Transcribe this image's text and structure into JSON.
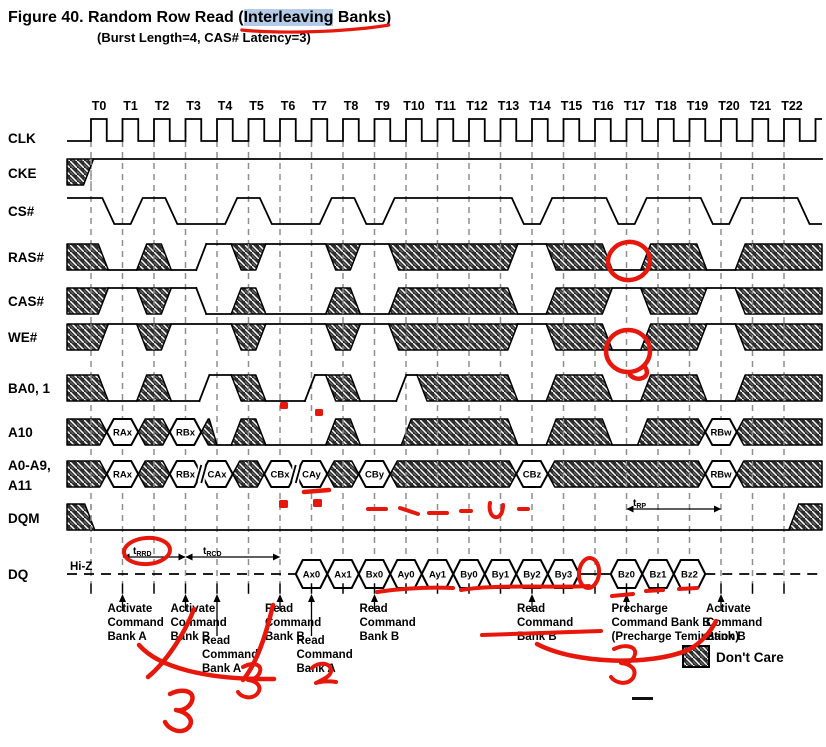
{
  "title": {
    "prefix": "Figure 40. Random Row Read (",
    "highlight": "Interleaving",
    "suffix": " Banks)",
    "subtitle": "(Burst Length=4, CAS# Latency=3)"
  },
  "colors": {
    "red": "#e8170b",
    "highlight_blue": "#b3cbe6",
    "hatch_bg": "#2d2d2d",
    "hatch_stripe": "#ffffff",
    "grid": "#8f8f8f",
    "black": "#000000"
  },
  "layout": {
    "t0_x": 91,
    "cycle_px": 31.5,
    "wave_left": 67,
    "wave_right": 822,
    "grid_top": 141,
    "grid_bot": 583,
    "tick_top": 584,
    "tick_bot": 593,
    "tlabel_y": 110,
    "clock_high": 119,
    "clock_low": 141
  },
  "time_labels": [
    "T0",
    "T1",
    "T2",
    "T3",
    "T4",
    "T5",
    "T6",
    "T7",
    "T8",
    "T9",
    "T10",
    "T11",
    "T12",
    "T13",
    "T14",
    "T15",
    "T16",
    "T17",
    "T18",
    "T19",
    "T20",
    "T21",
    "T22"
  ],
  "signals": [
    {
      "id": "clk",
      "label": "CLK",
      "type": "clock",
      "band": [
        119,
        141
      ],
      "label_y": 143
    },
    {
      "id": "cke",
      "label": "CKE",
      "type": "band",
      "band": [
        159,
        185
      ],
      "label_y": 178,
      "wins": [
        [
          0.08,
          99,
          "H"
        ]
      ]
    },
    {
      "id": "cs",
      "label": "CS#",
      "type": "cs",
      "band": [
        198,
        224
      ],
      "label_y": 216,
      "lows": [
        [
          0.55,
          1.45
        ],
        [
          2.55,
          4.45
        ],
        [
          5.55,
          7.45
        ],
        [
          8.55,
          9.45
        ],
        [
          13.55,
          14.45
        ],
        [
          16.55,
          17.45
        ],
        [
          19.55,
          20.45
        ],
        [
          22.62,
          99
        ]
      ]
    },
    {
      "id": "ras",
      "label": "RAS#",
      "type": "band",
      "band": [
        244,
        270
      ],
      "label_y": 262,
      "wins": [
        [
          0.55,
          1.45,
          "L"
        ],
        [
          2.55,
          3.5,
          "L"
        ],
        [
          3.5,
          4.45,
          "H"
        ],
        [
          5.55,
          7.45,
          "H"
        ],
        [
          8.55,
          9.45,
          "H"
        ],
        [
          13.55,
          14.45,
          "H"
        ],
        [
          16.55,
          17.45,
          "L"
        ],
        [
          19.55,
          20.45,
          "L"
        ]
      ]
    },
    {
      "id": "cas",
      "label": "CAS#",
      "type": "band",
      "band": [
        288,
        314
      ],
      "label_y": 306,
      "wins": [
        [
          0.55,
          1.45,
          "H"
        ],
        [
          2.55,
          3.5,
          "H"
        ],
        [
          3.5,
          4.45,
          "L"
        ],
        [
          5.55,
          7.45,
          "L"
        ],
        [
          8.55,
          9.45,
          "L"
        ],
        [
          13.55,
          14.45,
          "L"
        ],
        [
          16.55,
          17.45,
          "H"
        ],
        [
          19.55,
          20.45,
          "H"
        ]
      ]
    },
    {
      "id": "we",
      "label": "WE#",
      "type": "band",
      "band": [
        324,
        350
      ],
      "label_y": 342,
      "wins": [
        [
          0.55,
          1.45,
          "H"
        ],
        [
          2.55,
          4.45,
          "H"
        ],
        [
          5.55,
          7.45,
          "H"
        ],
        [
          8.55,
          9.45,
          "H"
        ],
        [
          13.55,
          14.45,
          "H"
        ],
        [
          16.55,
          17.45,
          "L"
        ],
        [
          19.55,
          20.45,
          "H"
        ]
      ]
    },
    {
      "id": "ba",
      "label": "BA0, 1",
      "type": "band",
      "band": [
        375,
        401
      ],
      "label_y": 393,
      "wins": [
        [
          0.55,
          1.45,
          "L"
        ],
        [
          2.55,
          3.6,
          "L"
        ],
        [
          3.6,
          4.45,
          "H"
        ],
        [
          5.55,
          6.95,
          "L"
        ],
        [
          6.95,
          7.45,
          "H"
        ],
        [
          8.55,
          9.85,
          "L"
        ],
        [
          9.85,
          10.35,
          "H"
        ],
        [
          13.55,
          14.45,
          "L"
        ],
        [
          16.55,
          17.45,
          "L"
        ],
        [
          19.55,
          20.45,
          "L"
        ]
      ]
    },
    {
      "id": "a10",
      "label": "A10",
      "type": "band",
      "band": [
        419,
        445
      ],
      "label_y": 437,
      "wins": [
        [
          0.5,
          1.5,
          "D",
          "RAx"
        ],
        [
          2.5,
          3.5,
          "D",
          "RBx"
        ],
        [
          4.0,
          4.45,
          "L"
        ],
        [
          5.55,
          7.45,
          "L"
        ],
        [
          8.55,
          9.85,
          "L"
        ],
        [
          13.55,
          14.45,
          "L"
        ],
        [
          16.55,
          17.35,
          "L"
        ],
        [
          19.5,
          20.5,
          "D",
          "RBw"
        ]
      ]
    },
    {
      "id": "a0a9",
      "label": "A0-A9,",
      "label2": "A11",
      "type": "band",
      "band": [
        461,
        487
      ],
      "label_y": 470,
      "label2_y": 490,
      "breaks": [
        3.5,
        6.5
      ],
      "wins": [
        [
          0.5,
          1.5,
          "D",
          "RAx"
        ],
        [
          2.5,
          3.5,
          "D",
          "RBx"
        ],
        [
          3.5,
          4.5,
          "D",
          "CAx"
        ],
        [
          5.5,
          6.5,
          "D",
          "CBx"
        ],
        [
          6.5,
          7.5,
          "D",
          "CAy"
        ],
        [
          8.5,
          9.5,
          "D",
          "CBy"
        ],
        [
          13.5,
          14.5,
          "D",
          "CBz"
        ],
        [
          19.5,
          20.5,
          "D",
          "RBw"
        ]
      ]
    },
    {
      "id": "dqm",
      "label": "DQM",
      "type": "band",
      "band": [
        504,
        530
      ],
      "label_y": 523,
      "wins": [
        [
          0.12,
          22.15,
          "L"
        ]
      ]
    },
    {
      "id": "dq",
      "label": "DQ",
      "type": "dq",
      "band": [
        560,
        588
      ],
      "label_y": 579,
      "hiz_label": "Hi-Z",
      "groups": [
        {
          "start": 7,
          "labels": [
            "Ax0",
            "Ax1",
            "Bx0",
            "Ay0",
            "Ay1",
            "By0",
            "By1",
            "By2",
            "By3"
          ]
        },
        {
          "start": 17,
          "labels": [
            "Bz0",
            "Bz1",
            "Bz2"
          ]
        }
      ]
    }
  ],
  "tparams": [
    {
      "main": "t",
      "sub": "RRD",
      "c0": 1,
      "c1": 3,
      "y": 557,
      "lx": 133,
      "ly": 554
    },
    {
      "main": "t",
      "sub": "RCD",
      "c0": 3,
      "c1": 6,
      "y": 557,
      "lx": 203,
      "ly": 554
    },
    {
      "main": "t",
      "sub": "RP",
      "c0": 17,
      "c1": 20,
      "y": 509,
      "lx": 633,
      "ly": 506
    }
  ],
  "commands": [
    {
      "c": 1,
      "long": false,
      "lines": [
        "Activate",
        "Command",
        "Bank A"
      ]
    },
    {
      "c": 3,
      "long": false,
      "lines": [
        "Activate",
        "Command",
        "Bank B"
      ]
    },
    {
      "c": 4,
      "long": true,
      "lines": [
        "Read",
        "Command",
        "Bank A"
      ]
    },
    {
      "c": 6,
      "long": false,
      "lines": [
        "Read",
        "Command",
        "Bank B"
      ]
    },
    {
      "c": 7,
      "long": true,
      "lines": [
        "Read",
        "Command",
        "Bank A"
      ]
    },
    {
      "c": 9,
      "long": false,
      "lines": [
        "Read",
        "Command",
        "Bank B"
      ]
    },
    {
      "c": 14,
      "long": false,
      "lines": [
        "Read",
        "Command",
        "Bank B"
      ]
    },
    {
      "c": 17,
      "long": false,
      "lines": [
        "Precharge",
        "Command Bank B",
        "(Precharge Temination)"
      ]
    },
    {
      "c": 20,
      "long": false,
      "lines": [
        "Activate",
        "Command",
        "Bank B"
      ]
    }
  ],
  "legend": {
    "label": "Don't Care",
    "box": [
      683,
      646,
      26,
      21
    ],
    "text_x": 716,
    "text_y": 662
  },
  "title_underline_d": "M2,6 C60,10 150,8 213,1",
  "annotations": [
    {
      "name": "ras-t17-circle",
      "k": "ellipse",
      "cx": 629,
      "cy": 261,
      "rx": 21,
      "ry": 19,
      "rot": -8,
      "w": 4.5
    },
    {
      "name": "we-t17-circle",
      "k": "ellipse",
      "cx": 628,
      "cy": 351,
      "rx": 22,
      "ry": 21,
      "rot": 0,
      "w": 4.5
    },
    {
      "name": "we-circle-tail",
      "k": "path",
      "d": "M645,367 C652,377 638,383 630,375",
      "w": 4.5
    },
    {
      "name": "trrd-circle",
      "k": "ellipse",
      "cx": 147,
      "cy": 551,
      "rx": 23,
      "ry": 13,
      "rot": -4,
      "w": 4
    },
    {
      "name": "ba-dot-1",
      "k": "rect",
      "x": 280,
      "y": 402,
      "wd": 8,
      "h": 7
    },
    {
      "name": "ba-dot-2",
      "k": "rect",
      "x": 315,
      "y": 409,
      "wd": 8,
      "h": 7
    },
    {
      "name": "cay-underline",
      "k": "path",
      "d": "M304,492 L329,490",
      "w": 4.5
    },
    {
      "name": "a0a9-dot-1",
      "k": "rect",
      "x": 279,
      "y": 500,
      "wd": 9,
      "h": 8
    },
    {
      "name": "a0a9-dot-2",
      "k": "rect",
      "x": 313,
      "y": 499,
      "wd": 9,
      "h": 8
    },
    {
      "name": "dqm-dash-1",
      "k": "path",
      "d": "M368,509 L386,509",
      "w": 4
    },
    {
      "name": "dqm-dash-2",
      "k": "path",
      "d": "M400,508 L418,514",
      "w": 4
    },
    {
      "name": "dqm-dash-3",
      "k": "path",
      "d": "M429,513 L447,513",
      "w": 4
    },
    {
      "name": "dqm-dash-4",
      "k": "path",
      "d": "M461,511 L471,511",
      "w": 4
    },
    {
      "name": "dqm-u-mark",
      "k": "path",
      "d": "M490,503 C487,520 503,523 503,505",
      "w": 4
    },
    {
      "name": "dqm-dash-5",
      "k": "path",
      "d": "M519,509 L528,509",
      "w": 4
    },
    {
      "name": "dq-underline-1",
      "k": "path",
      "d": "M377,592 C405,588 430,587 453,588",
      "w": 4
    },
    {
      "name": "dq-underline-2",
      "k": "path",
      "d": "M461,590 C500,584 555,588 589,586",
      "w": 4
    },
    {
      "name": "dq-gap-circle",
      "k": "ellipse",
      "cx": 589,
      "cy": 573,
      "rx": 10,
      "ry": 15,
      "rot": 6,
      "w": 4
    },
    {
      "name": "bz-dash-1",
      "k": "path",
      "d": "M612,596 L633,594",
      "w": 4
    },
    {
      "name": "bz-dash-2",
      "k": "path",
      "d": "M646,591 L663,590",
      "w": 4
    },
    {
      "name": "bz-dash-3",
      "k": "path",
      "d": "M679,589 L697,588",
      "w": 4
    },
    {
      "name": "precharge-underline",
      "k": "path",
      "d": "M482,635 L601,631",
      "w": 4
    },
    {
      "name": "precharge-arc",
      "k": "path",
      "d": "M537,644 C575,664 650,666 688,650 C700,644 710,633 716,621",
      "w": 4.5
    },
    {
      "name": "digit-3-right",
      "k": "path",
      "glyph": "3",
      "d": "M614,649 C627,643 639,647 634,657 C631,663 623,664 621,663 C630,664 638,669 633,678 C627,686 615,683 611,677",
      "w": 4
    },
    {
      "name": "curve-left-a",
      "k": "path",
      "d": "M139,645 C158,667 205,680 274,679",
      "w": 4.5
    },
    {
      "name": "curve-left-b",
      "k": "path",
      "d": "M194,609 C184,635 166,662 148,677",
      "w": 4.5
    },
    {
      "name": "curve-left-c",
      "k": "path",
      "d": "M273,605 C266,635 257,663 243,680",
      "w": 4.5
    },
    {
      "name": "digit-3-mid",
      "k": "path",
      "glyph": "3",
      "d": "M243,667 C254,661 264,665 259,674 C256,679 250,680 248,680 C257,681 263,687 257,694 C251,700 241,697 238,692",
      "w": 4
    },
    {
      "name": "digit-2",
      "k": "path",
      "glyph": "2",
      "d": "M312,668 C318,662 330,662 331,670 C332,676 322,680 316,683 C322,681 331,681 336,682",
      "w": 4
    },
    {
      "name": "digit-3-big",
      "k": "path",
      "glyph": "3",
      "d": "M170,694 C184,687 197,692 191,703 C187,710 179,711 176,710 C186,712 195,719 189,727 C182,735 169,730 165,722",
      "w": 4.5
    }
  ],
  "extras": [
    {
      "name": "black-dash",
      "k": "rect",
      "x": 632,
      "y": 697,
      "wd": 21,
      "h": 3,
      "color": "#111111"
    }
  ]
}
